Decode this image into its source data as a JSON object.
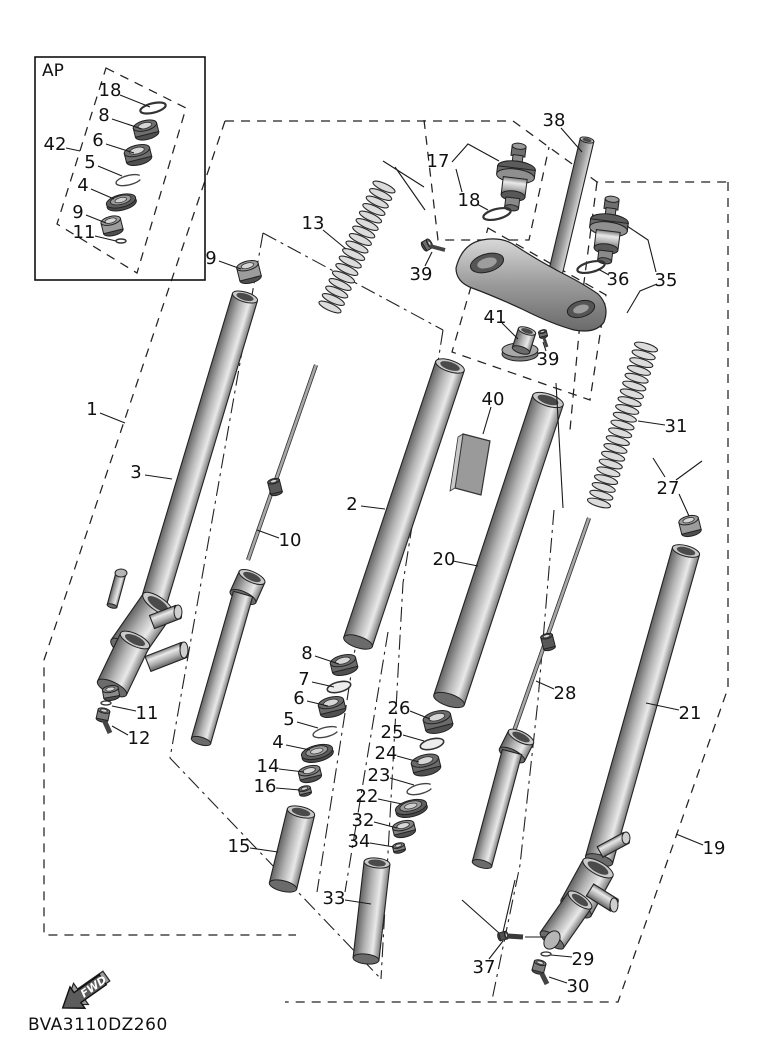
{
  "figure": {
    "code": "BVA3110DZ260",
    "fwd": "FWD",
    "ap": "AP"
  },
  "callouts": [
    {
      "n": "18",
      "x": 110,
      "y": 90,
      "leader": [
        [
          120,
          95
        ],
        [
          150,
          107
        ]
      ]
    },
    {
      "n": "8",
      "x": 104,
      "y": 115,
      "leader": [
        [
          112,
          119
        ],
        [
          142,
          129
        ]
      ]
    },
    {
      "n": "6",
      "x": 98,
      "y": 140,
      "leader": [
        [
          106,
          144
        ],
        [
          134,
          153
        ]
      ]
    },
    {
      "n": "5",
      "x": 90,
      "y": 162,
      "leader": [
        [
          98,
          166
        ],
        [
          122,
          176
        ]
      ]
    },
    {
      "n": "4",
      "x": 83,
      "y": 185,
      "leader": [
        [
          91,
          189
        ],
        [
          114,
          199
        ]
      ]
    },
    {
      "n": "9",
      "x": 78,
      "y": 212,
      "leader": [
        [
          86,
          215
        ],
        [
          106,
          223
        ]
      ]
    },
    {
      "n": "11",
      "x": 84,
      "y": 232,
      "leader": [
        [
          95,
          236
        ],
        [
          116,
          241
        ]
      ]
    },
    {
      "n": "42",
      "x": 55,
      "y": 144,
      "leader": [
        [
          66,
          148
        ],
        [
          80,
          151
        ]
      ]
    },
    {
      "n": "9",
      "x": 211,
      "y": 258,
      "leader": [
        [
          219,
          261
        ],
        [
          241,
          269
        ]
      ]
    },
    {
      "n": "13",
      "x": 313,
      "y": 223,
      "leader": [
        [
          323,
          230
        ],
        [
          346,
          249
        ]
      ]
    },
    {
      "n": "1",
      "x": 92,
      "y": 409,
      "leader": [
        [
          100,
          413
        ],
        [
          125,
          423
        ]
      ]
    },
    {
      "n": "3",
      "x": 136,
      "y": 472,
      "leader": [
        [
          145,
          475
        ],
        [
          172,
          479
        ]
      ]
    },
    {
      "n": "10",
      "x": 290,
      "y": 540,
      "leader": [
        [
          279,
          538
        ],
        [
          257,
          530
        ]
      ]
    },
    {
      "n": "11",
      "x": 147,
      "y": 713,
      "leader": [
        [
          136,
          711
        ],
        [
          112,
          706
        ]
      ]
    },
    {
      "n": "12",
      "x": 139,
      "y": 738,
      "leader": [
        [
          128,
          735
        ],
        [
          112,
          726
        ]
      ]
    },
    {
      "n": "2",
      "x": 352,
      "y": 504,
      "leader": [
        [
          361,
          506
        ],
        [
          385,
          509
        ]
      ]
    },
    {
      "n": "40",
      "x": 493,
      "y": 399,
      "leader": [
        [
          491,
          407
        ],
        [
          483,
          434
        ]
      ]
    },
    {
      "n": "20",
      "x": 444,
      "y": 559,
      "leader": [
        [
          453,
          561
        ],
        [
          478,
          566
        ]
      ]
    },
    {
      "n": "8",
      "x": 307,
      "y": 653,
      "leader": [
        [
          315,
          656
        ],
        [
          339,
          664
        ]
      ]
    },
    {
      "n": "7",
      "x": 304,
      "y": 679,
      "leader": [
        [
          312,
          682
        ],
        [
          334,
          687
        ]
      ]
    },
    {
      "n": "6",
      "x": 299,
      "y": 698,
      "leader": [
        [
          307,
          701
        ],
        [
          328,
          706
        ]
      ]
    },
    {
      "n": "5",
      "x": 289,
      "y": 719,
      "leader": [
        [
          297,
          722
        ],
        [
          318,
          728
        ]
      ]
    },
    {
      "n": "4",
      "x": 278,
      "y": 742,
      "leader": [
        [
          286,
          745
        ],
        [
          310,
          750
        ]
      ]
    },
    {
      "n": "14",
      "x": 268,
      "y": 766,
      "leader": [
        [
          279,
          769
        ],
        [
          304,
          772
        ]
      ]
    },
    {
      "n": "16",
      "x": 265,
      "y": 786,
      "leader": [
        [
          276,
          788
        ],
        [
          300,
          790
        ]
      ]
    },
    {
      "n": "15",
      "x": 239,
      "y": 846,
      "leader": [
        [
          250,
          848
        ],
        [
          278,
          852
        ]
      ]
    },
    {
      "n": "26",
      "x": 399,
      "y": 708,
      "leader": [
        [
          410,
          711
        ],
        [
          430,
          719
        ]
      ]
    },
    {
      "n": "25",
      "x": 392,
      "y": 732,
      "leader": [
        [
          403,
          735
        ],
        [
          424,
          741
        ]
      ]
    },
    {
      "n": "24",
      "x": 386,
      "y": 753,
      "leader": [
        [
          397,
          756
        ],
        [
          419,
          762
        ]
      ]
    },
    {
      "n": "23",
      "x": 379,
      "y": 775,
      "leader": [
        [
          390,
          778
        ],
        [
          414,
          785
        ]
      ]
    },
    {
      "n": "22",
      "x": 367,
      "y": 796,
      "leader": [
        [
          378,
          799
        ],
        [
          402,
          804
        ]
      ]
    },
    {
      "n": "32",
      "x": 363,
      "y": 820,
      "leader": [
        [
          374,
          822
        ],
        [
          397,
          828
        ]
      ]
    },
    {
      "n": "34",
      "x": 359,
      "y": 841,
      "leader": [
        [
          370,
          843
        ],
        [
          394,
          847
        ]
      ]
    },
    {
      "n": "33",
      "x": 334,
      "y": 898,
      "leader": [
        [
          345,
          900
        ],
        [
          371,
          904
        ]
      ]
    },
    {
      "n": "17",
      "x": 438,
      "y": 161,
      "leader": []
    },
    {
      "n": "18",
      "x": 469,
      "y": 200,
      "leader": [
        [
          477,
          204
        ],
        [
          488,
          210
        ]
      ]
    },
    {
      "n": "38",
      "x": 554,
      "y": 120,
      "leader": [
        [
          561,
          128
        ],
        [
          582,
          152
        ]
      ]
    },
    {
      "n": "39",
      "x": 421,
      "y": 274,
      "leader": [
        [
          425,
          266
        ],
        [
          432,
          252
        ]
      ]
    },
    {
      "n": "41",
      "x": 495,
      "y": 317,
      "leader": [
        [
          502,
          323
        ],
        [
          518,
          339
        ]
      ]
    },
    {
      "n": "39",
      "x": 548,
      "y": 359,
      "leader": [
        [
          546,
          351
        ],
        [
          543,
          342
        ]
      ]
    },
    {
      "n": "36",
      "x": 618,
      "y": 279,
      "leader": [
        [
          609,
          275
        ],
        [
          598,
          269
        ]
      ]
    },
    {
      "n": "35",
      "x": 666,
      "y": 280,
      "leader": []
    },
    {
      "n": "31",
      "x": 676,
      "y": 426,
      "leader": [
        [
          665,
          425
        ],
        [
          638,
          421
        ]
      ]
    },
    {
      "n": "27",
      "x": 668,
      "y": 488,
      "leader": []
    },
    {
      "n": "21",
      "x": 690,
      "y": 713,
      "leader": [
        [
          679,
          710
        ],
        [
          646,
          703
        ]
      ]
    },
    {
      "n": "28",
      "x": 565,
      "y": 693,
      "leader": [
        [
          554,
          689
        ],
        [
          536,
          681
        ]
      ]
    },
    {
      "n": "19",
      "x": 714,
      "y": 848,
      "leader": [
        [
          703,
          845
        ],
        [
          676,
          834
        ]
      ]
    },
    {
      "n": "37",
      "x": 484,
      "y": 967,
      "leader": [
        [
          489,
          959
        ],
        [
          503,
          941
        ]
      ]
    },
    {
      "n": "29",
      "x": 583,
      "y": 959,
      "leader": [
        [
          572,
          957
        ],
        [
          551,
          955
        ]
      ]
    },
    {
      "n": "30",
      "x": 578,
      "y": 986,
      "leader": [
        [
          567,
          983
        ],
        [
          549,
          977
        ]
      ]
    }
  ]
}
